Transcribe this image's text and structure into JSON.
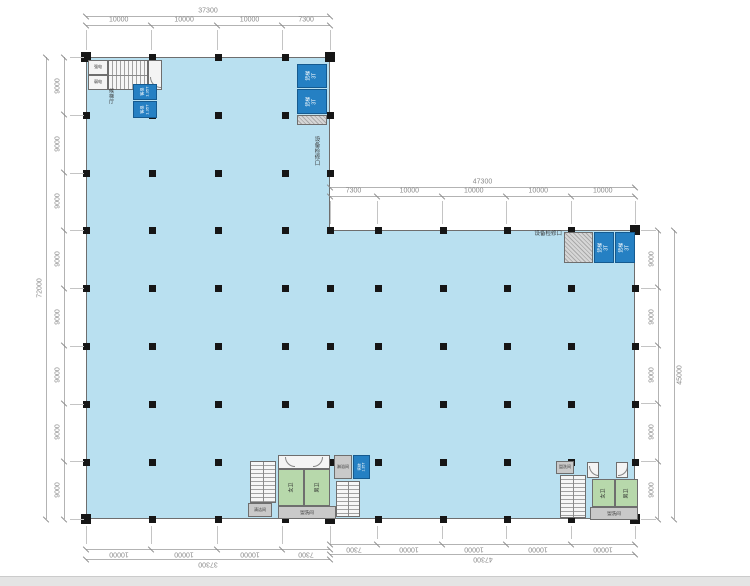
{
  "colors": {
    "floor_fill": "#b9e0f0",
    "elevator_blue": "#2580c3",
    "toilet_green": "#b7d8ab",
    "service_gray": "#c9c9c9",
    "wall": "#6e6e6e",
    "dimension": "#8a8a8a"
  },
  "dimensions": {
    "top_left": {
      "total": "37300",
      "segments": [
        "10000",
        "10000",
        "10000",
        "7300"
      ]
    },
    "top_right": {
      "total": "47300",
      "segments": [
        "7300",
        "10000",
        "10000",
        "10000",
        "10000"
      ]
    },
    "left": {
      "total": "72000",
      "segments": [
        "9000",
        "9000",
        "9000",
        "9000",
        "9000",
        "9000",
        "9000",
        "9000"
      ]
    },
    "right": {
      "total": "45000",
      "segments": [
        "9000",
        "9000",
        "9000",
        "9000",
        "9000"
      ]
    },
    "bottom_left": {
      "total": "37300",
      "segments": [
        "10000",
        "10000",
        "10000",
        "7300"
      ]
    },
    "bottom_right": {
      "total": "47300",
      "segments": [
        "7300",
        "10000",
        "10000",
        "10000",
        "10000"
      ]
    }
  },
  "labels": {
    "elevator_lobby": "候梯厅",
    "equipment_access": "设备检修口",
    "passenger_elevator": "客梯\n1.35T",
    "freight_elevator": "货梯\n3T",
    "toilet_female": "女卫",
    "toilet_male": "男卫",
    "washroom": "盥洗间",
    "shower_room": "淋浴间",
    "cleaning_room": "清洁间",
    "strong_power": "强电",
    "weak_power": "弱电"
  }
}
